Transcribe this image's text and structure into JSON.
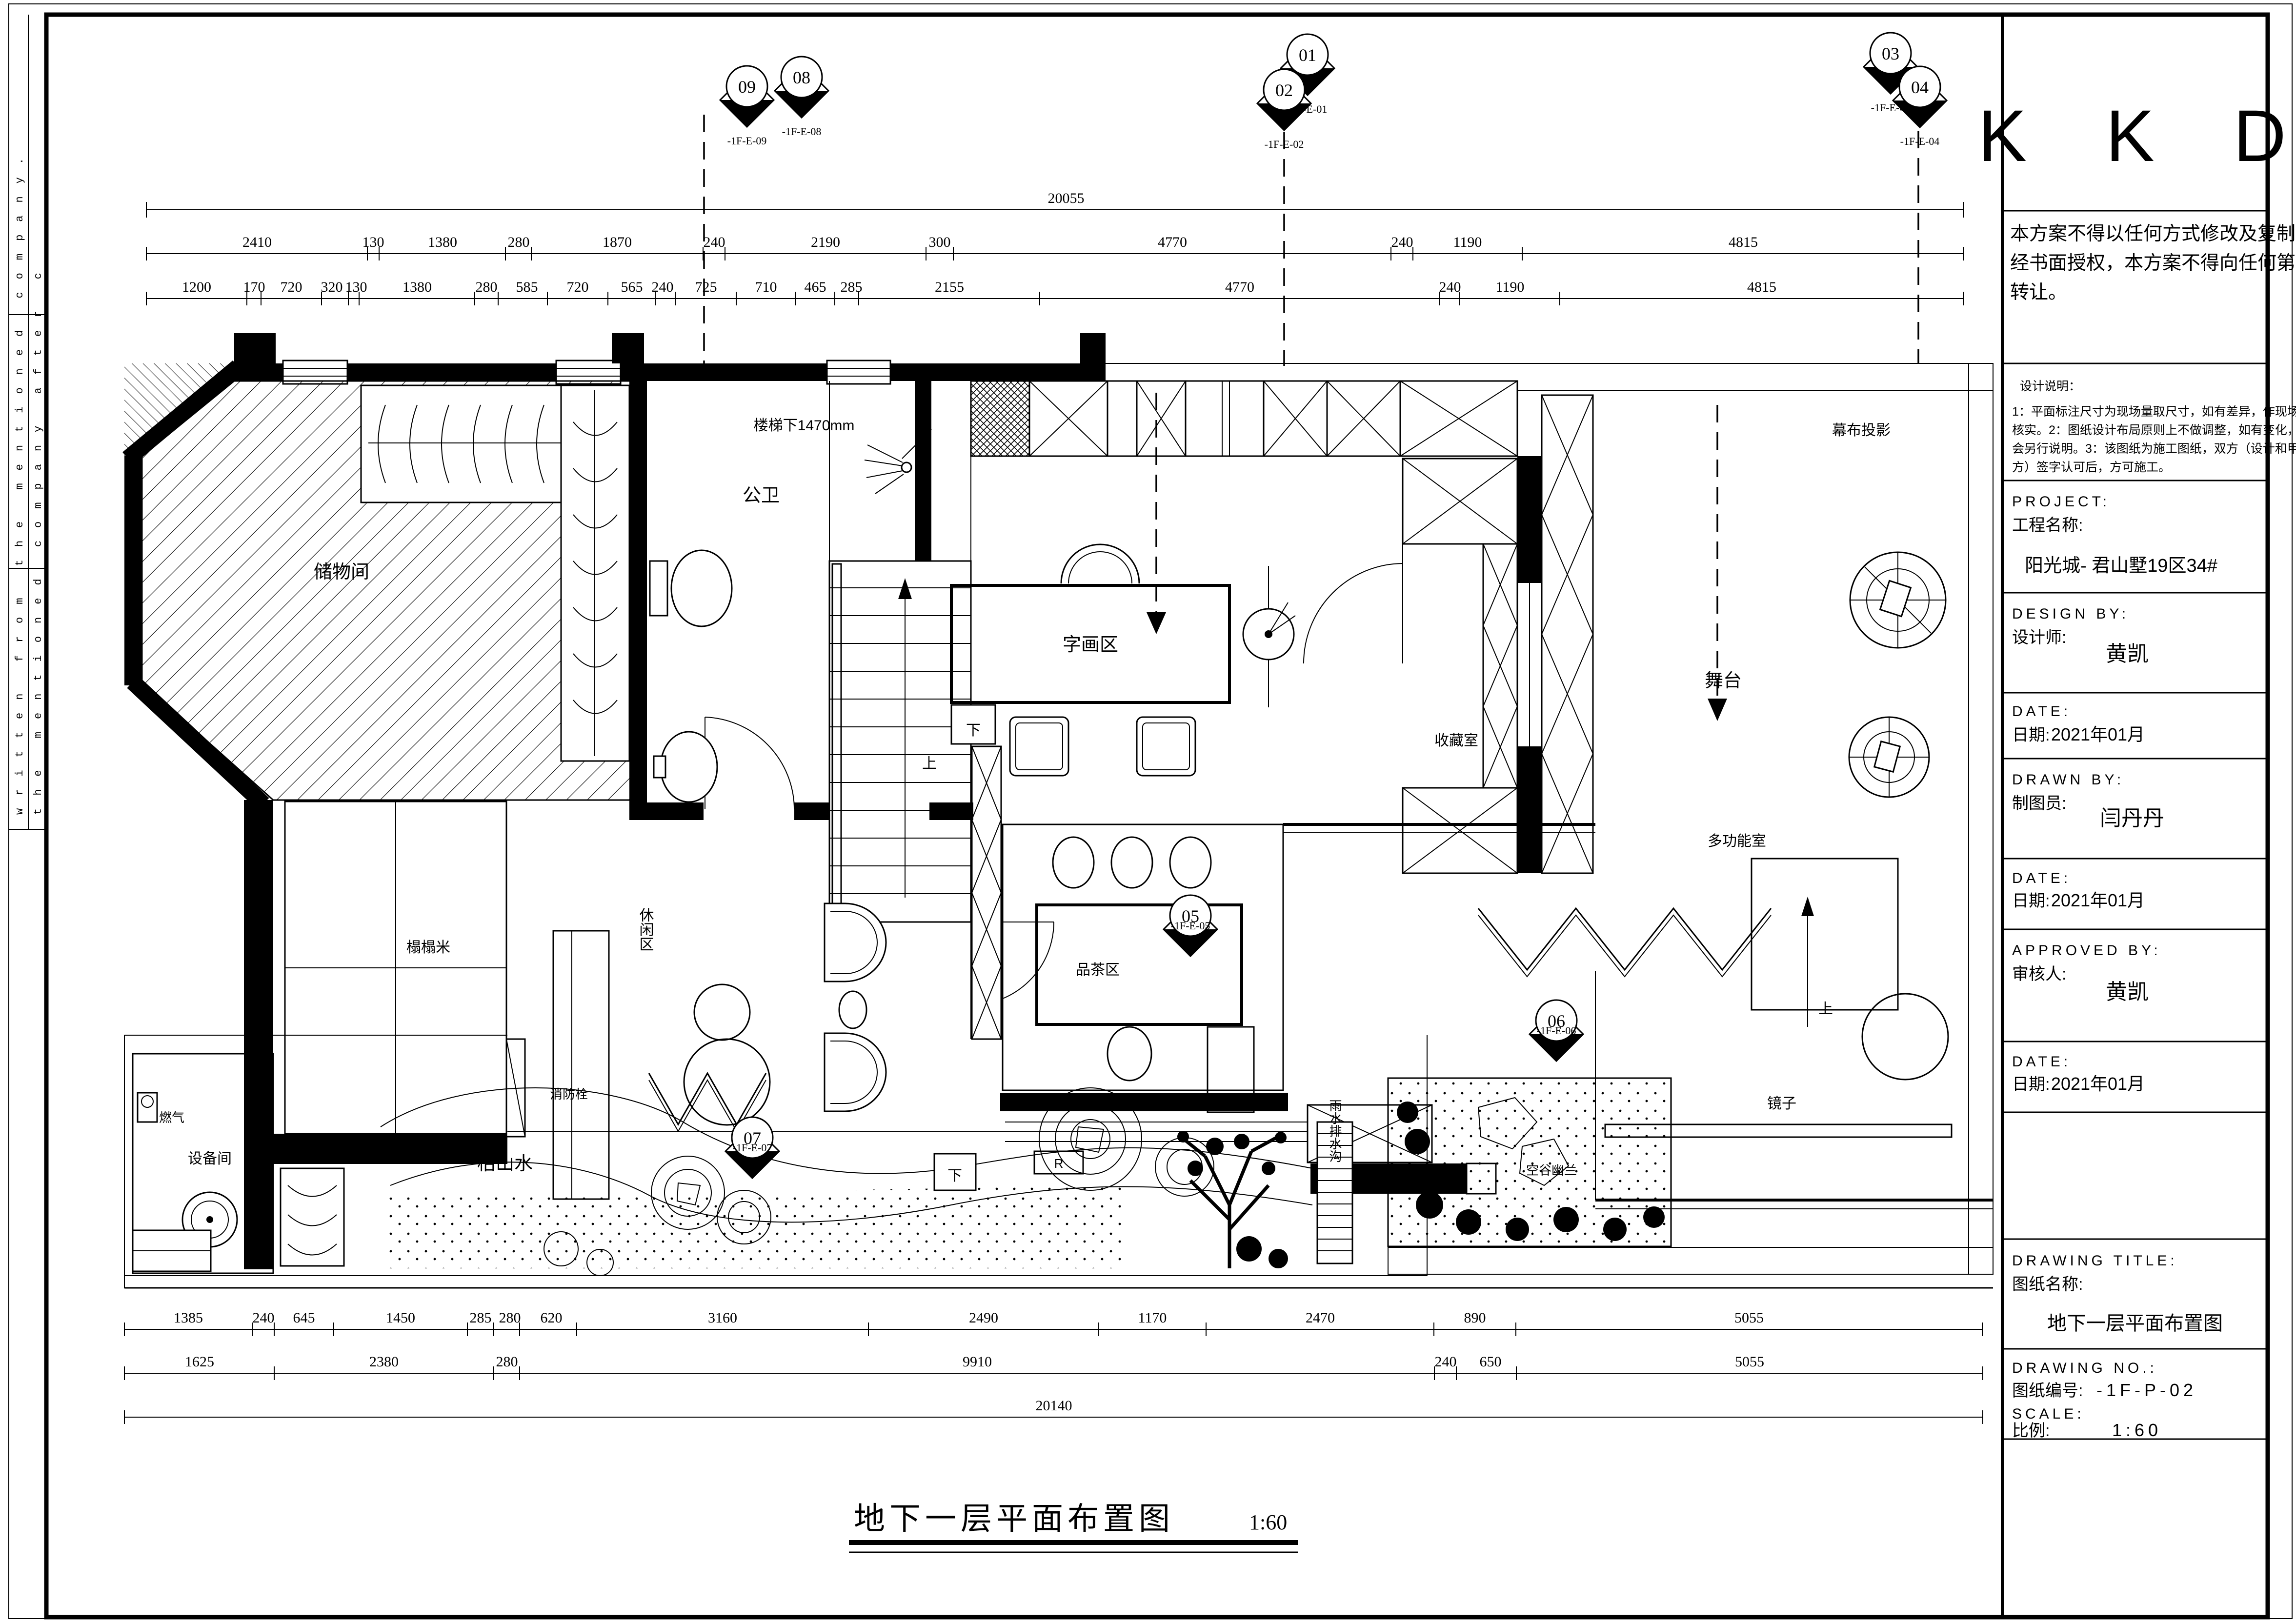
{
  "sheet": {
    "side_text_1": "written from the mentioned company.",
    "side_text_2": "the mentioned company after c"
  },
  "bottom_title": {
    "text": "地下一层平面布置图",
    "scale": "1:60"
  },
  "title_block": {
    "logo": "K K D",
    "disclaimer_lines": [
      "本方案不得以任何方式修改及复制。未",
      "经书面授权，本方案不得向任何第三方",
      "转让。"
    ],
    "notes_title": "设计说明：",
    "notes_lines": [
      "1：平面标注尺寸为现场量取尺寸，如有差异，作现场",
      "核实。2：图纸设计布局原则上不做调整，如有变化，",
      "会另行说明。3：该图纸为施工图纸，双方（设计和甲",
      "方）签字认可后，方可施工。"
    ],
    "project_en": "PROJECT:",
    "project_cn": "工程名称:",
    "project_value": "阳光城- 君山墅19区34#",
    "design_by_en": "DESIGN BY:",
    "design_by_cn": "设计师:",
    "design_by_value": "黄凯",
    "date_en": "DATE:",
    "date_cn": "日期:",
    "date1": "2021年01月",
    "drawn_by_en": "DRAWN BY:",
    "drawn_by_cn": "制图员:",
    "drawn_by_value": "闫丹丹",
    "date2": "2021年01月",
    "approved_en": "APPROVED BY:",
    "approved_cn": "审核人:",
    "approved_value": "黄凯",
    "date3": "2021年01月",
    "drawing_title_en": "DRAWING TITLE:",
    "drawing_title_cn": "图纸名称:",
    "drawing_title_value": "地下一层平面布置图",
    "drawing_no_en": "DRAWING NO.:",
    "drawing_no_cn": "图纸编号:",
    "drawing_no_value": "-1F-P-02",
    "scale_en": "SCALE:",
    "scale_cn": "比例:",
    "scale_value": "1:60"
  },
  "markers": {
    "m01": {
      "num": "01",
      "code": "-1F-E-01"
    },
    "m02": {
      "num": "02",
      "code": "-1F-E-02"
    },
    "m03": {
      "num": "03",
      "code": "-1F-E-03"
    },
    "m04": {
      "num": "04",
      "code": "-1F-E-04"
    },
    "m05": {
      "num": "05",
      "code": "-1F-E-05"
    },
    "m06": {
      "num": "06",
      "code": "-1F-E-06"
    },
    "m07": {
      "num": "07",
      "code": "-1F-E-07"
    },
    "m08": {
      "num": "08",
      "code": "-1F-E-08"
    },
    "m09": {
      "num": "09",
      "code": "-1F-E-09"
    }
  },
  "labels": {
    "storage": "储物间",
    "wc": "公卫",
    "stair_note": "楼梯下1470mm",
    "up": "上",
    "down": "下",
    "r_mark": "R",
    "calligraphy": "字画区",
    "collection": "收藏室",
    "stage": "舞台",
    "curtain": "幕布投影",
    "multi_room": "多功能室",
    "mirror": "镜子",
    "tea": "品茶区",
    "leisure": "休闲区",
    "tatami": "榻榻米",
    "hydrant": "消防栓",
    "dry_landscape": "枯山水",
    "equipment": "设备间",
    "gas": "燃气",
    "drain": "雨水排水沟",
    "garden_name": "空谷幽兰"
  },
  "dims": {
    "top_total": "20055",
    "top_row2": [
      "2410",
      "130",
      "1380",
      "280",
      "1870",
      "240",
      "2190",
      "300",
      "4770",
      "240",
      "1190",
      "4815"
    ],
    "top_row3": [
      "1200",
      "170",
      "720",
      "320",
      "130",
      "1380",
      "280",
      "585",
      "720",
      "565",
      "240",
      "725",
      "710",
      "465",
      "285",
      "2155",
      "4770",
      "240",
      "1190",
      "4815"
    ],
    "bottom_row1": [
      "1385",
      "240",
      "645",
      "1450",
      "285",
      "280",
      "620",
      "3160",
      "2490",
      "1170",
      "2470",
      "890",
      "5055"
    ],
    "bottom_row2": [
      "1625",
      "2380",
      "280",
      "9910",
      "240",
      "650",
      "5055"
    ],
    "bottom_total": "20140"
  }
}
